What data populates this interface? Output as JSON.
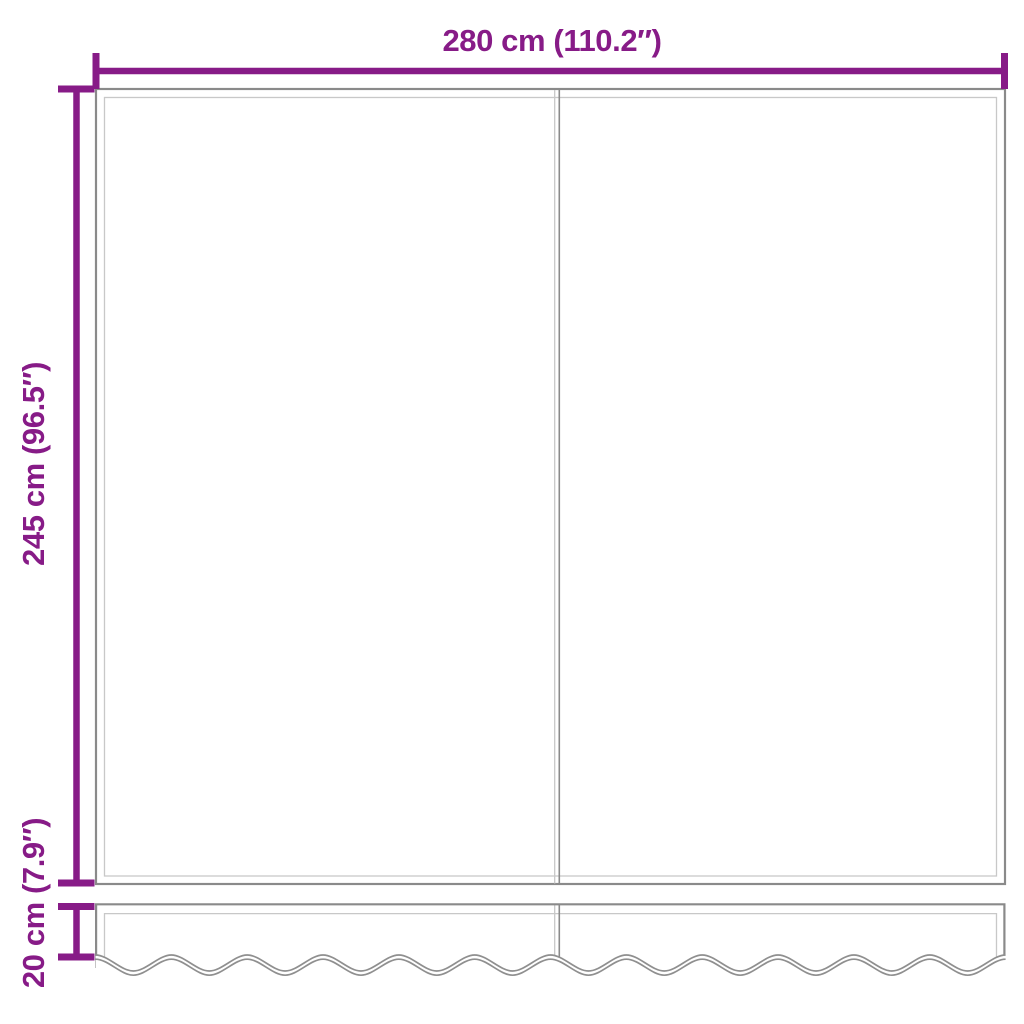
{
  "diagram": {
    "title": "awning-fabric-with-valance-dimension-diagram",
    "labels": {
      "width": "280 cm (110.2″)",
      "height": "245 cm (96.5″)",
      "valance_height": "20 cm (7.9″)"
    },
    "structure": {
      "panel_count": 2,
      "scallop_count": 12
    },
    "colors": {
      "dimension": "#871B87",
      "outline": "#8A8A8A",
      "hem": "#C8C8C8",
      "background": "#FFFFFF"
    }
  }
}
